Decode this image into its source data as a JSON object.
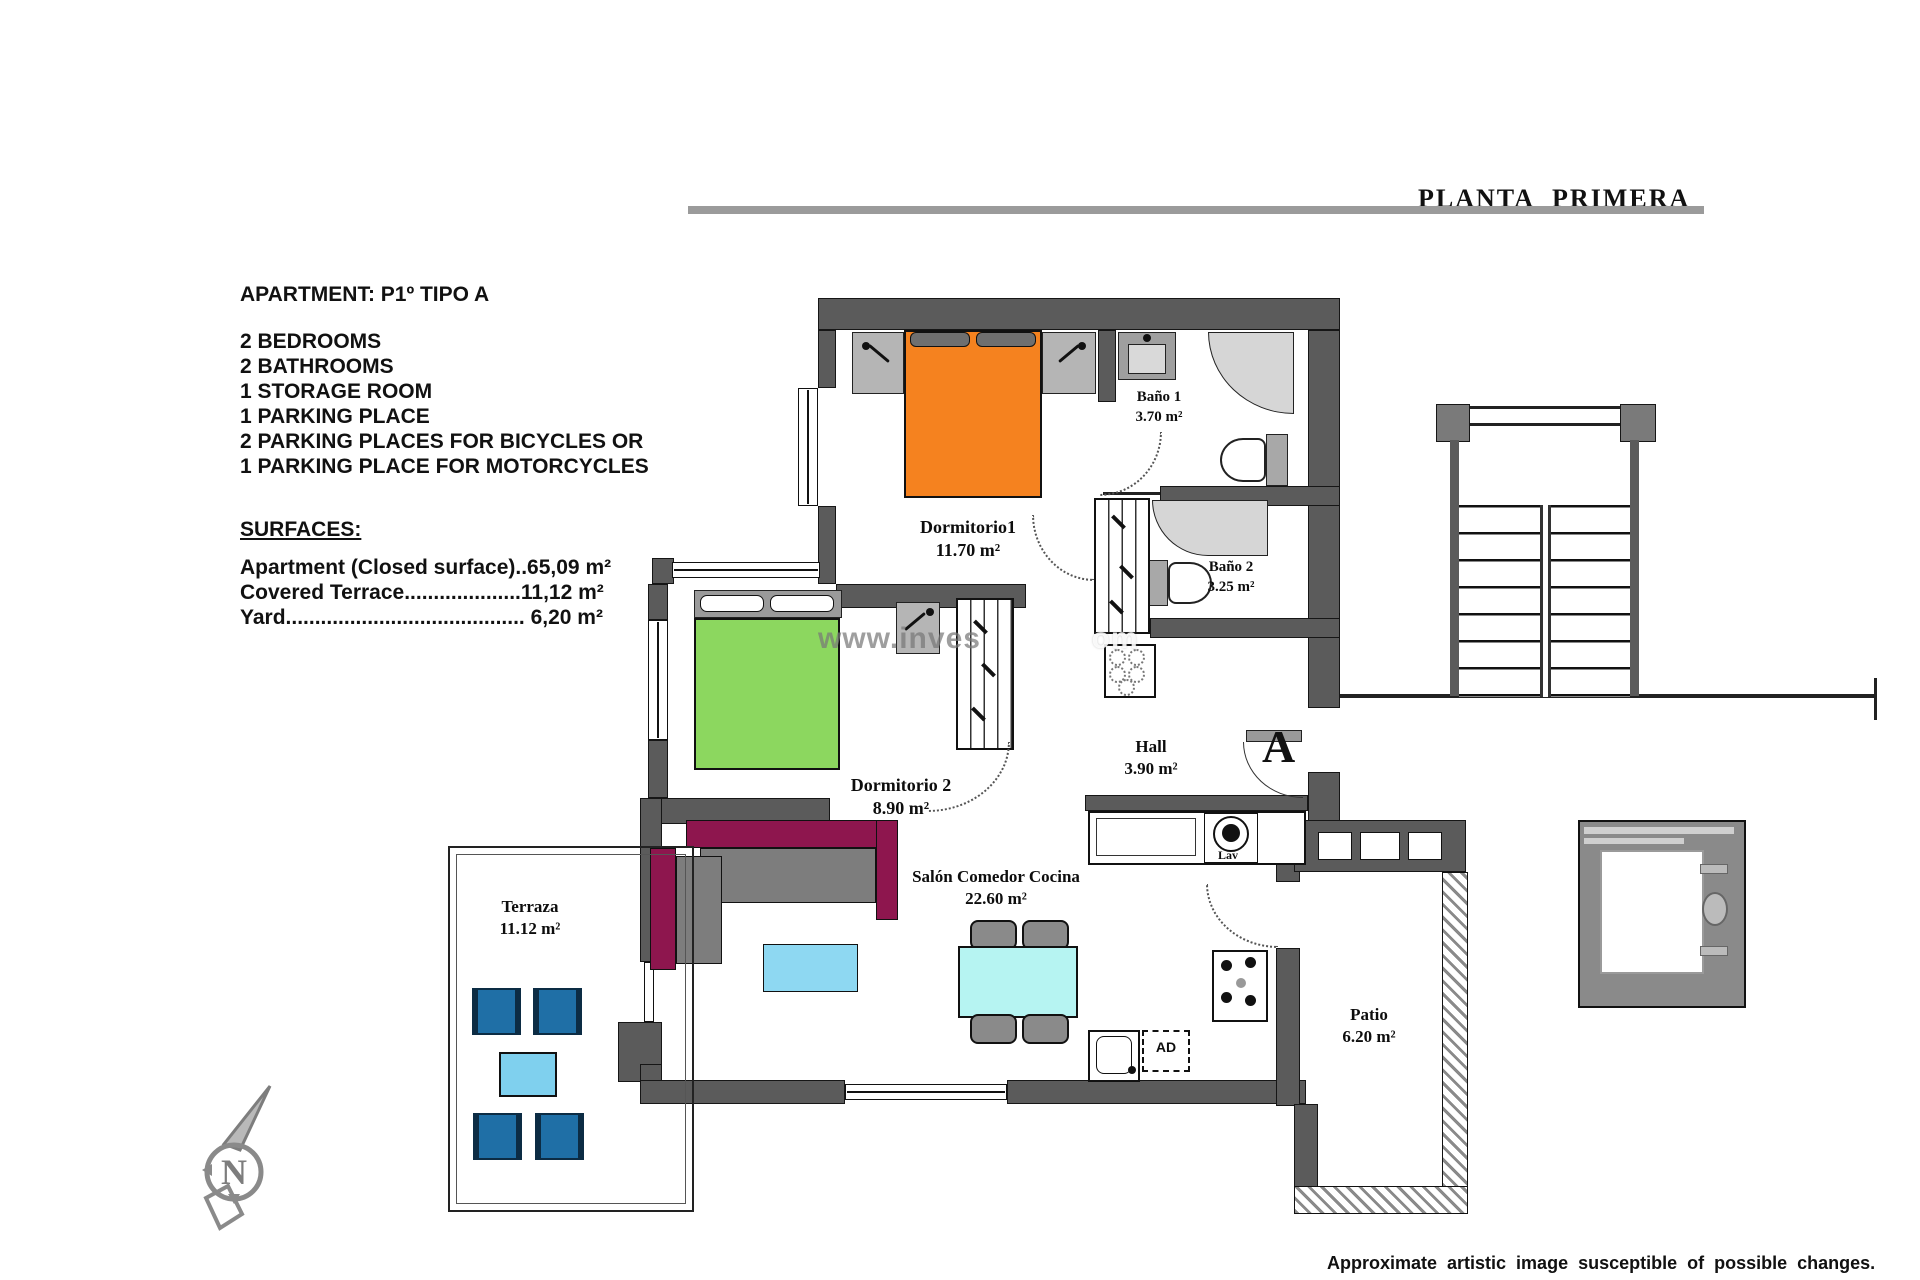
{
  "title": "PLANTA PRIMERA",
  "info": {
    "apartment": "APARTMENT: P1º TIPO A",
    "features": [
      "2 BEDROOMS",
      "2 BATHROOMS",
      "1 STORAGE ROOM",
      "1 PARKING PLACE",
      "2 PARKING PLACES FOR BICYCLES OR",
      "1 PARKING PLACE FOR MOTORCYCLES"
    ],
    "surfaces_heading": "SURFACES:",
    "surfaces": [
      "Apartment (Closed surface)..65,09 m²",
      "Covered Terrace....................11,12 m²",
      "Yard......................................... 6,20 m²"
    ]
  },
  "rooms": {
    "dormitorio1": {
      "name": "Dormitorio1",
      "area": "11.70 m²"
    },
    "bano1": {
      "name": "Baño 1",
      "area": "3.70 m²"
    },
    "bano2": {
      "name": "Baño 2",
      "area": "3.25 m²"
    },
    "dormitorio2": {
      "name": "Dormitorio 2",
      "area": "8.90 m²"
    },
    "hall": {
      "name": "Hall",
      "area": "3.90 m²"
    },
    "salon": {
      "name": "Salón Comedor Cocina",
      "area": "22.60 m²"
    },
    "terraza": {
      "name": "Terraza",
      "area": "11.12 m²"
    },
    "patio": {
      "name": "Patio",
      "area": "6.20 m²"
    }
  },
  "annotations": {
    "lav": "Lav",
    "ad": "AD",
    "section_marker": "A",
    "north": "N"
  },
  "watermark": {
    "left": "www.inves",
    "right": "om"
  },
  "footer": "Approximate artistic image susceptible of possible changes.",
  "colors": {
    "wall": "#5b5b5b",
    "bed_orange": "#F5821F",
    "bed_green": "#8CD75F",
    "sofa_back": "#8E164E",
    "dining_table": "#B6F4F2",
    "coffee_table": "#8ED8F2",
    "terrace_chair": "#1F6FA6",
    "terrace_table": "#7FD0EE"
  }
}
